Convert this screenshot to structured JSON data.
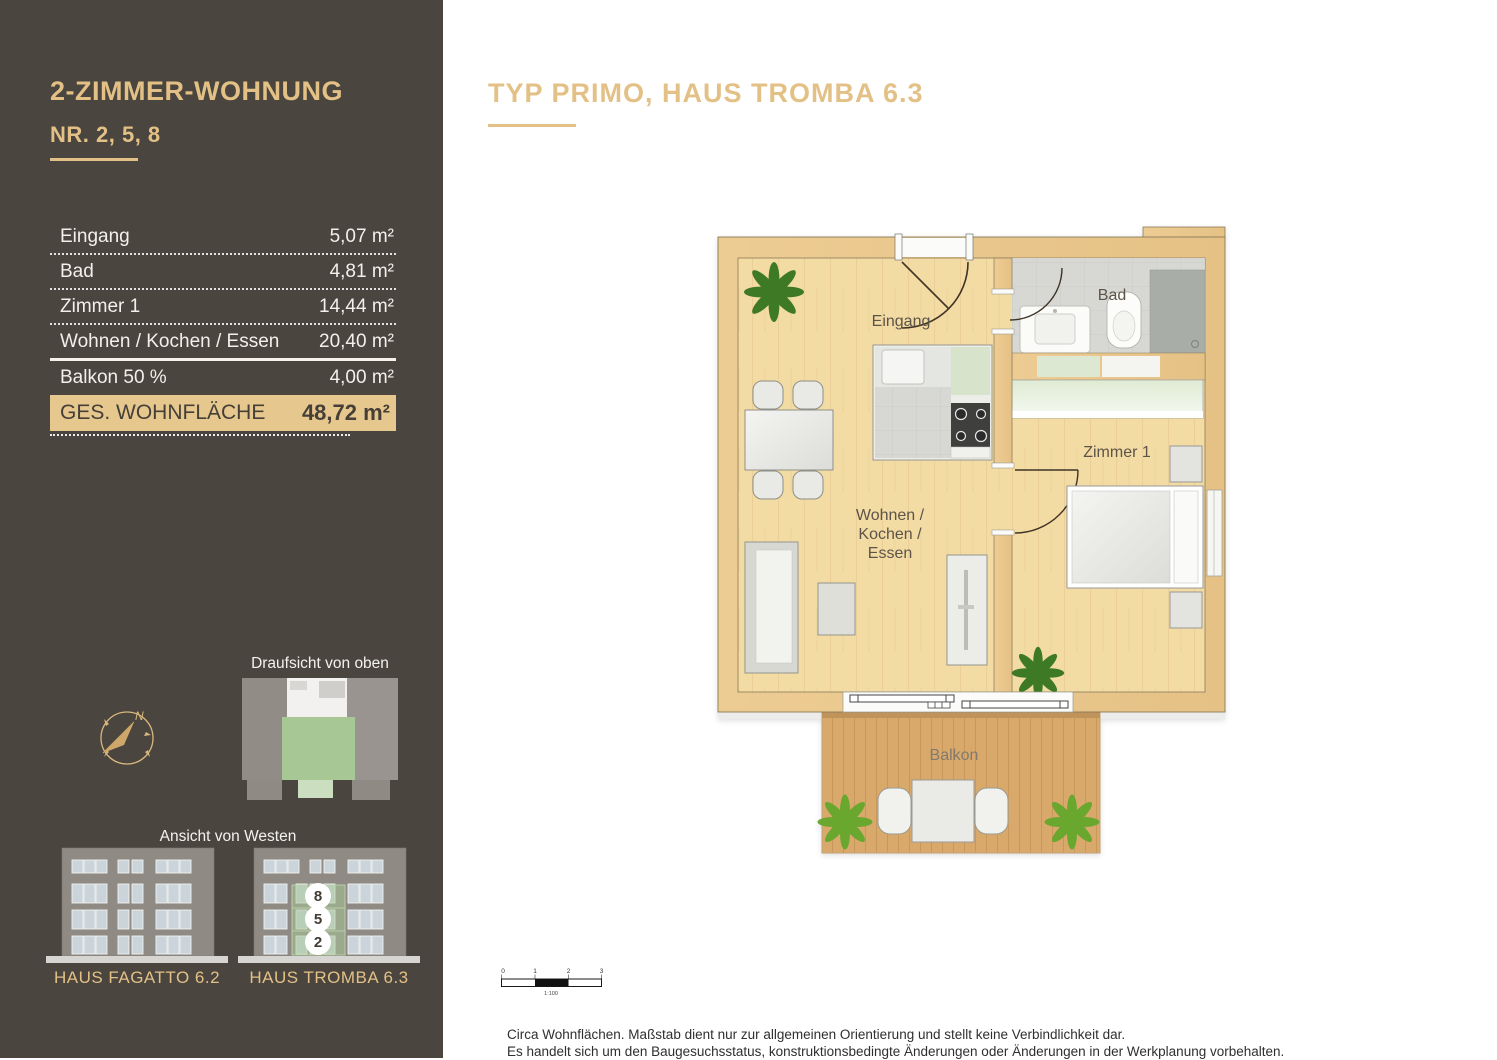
{
  "sidebar": {
    "title": "2-ZIMMER-WOHNUNG",
    "subtitle": "NR. 2, 5, 8",
    "area_table": {
      "rows": [
        {
          "label": "Eingang",
          "value": "5,07 m²"
        },
        {
          "label": "Bad",
          "value": "4,81 m²"
        },
        {
          "label": "Zimmer 1",
          "value": "14,44 m²"
        },
        {
          "label": "Wohnen / Kochen / Essen",
          "value": "20,40 m²"
        },
        {
          "label": "Balkon 50 %",
          "value": "4,00 m²"
        }
      ],
      "total": {
        "label": "GES. WOHNFLÄCHE",
        "value": "48,72 m²"
      }
    },
    "compass": {
      "north_label": "N"
    },
    "top_view": {
      "caption": "Draufsicht von oben"
    },
    "elevation": {
      "caption": "Ansicht von Westen",
      "buildings": [
        {
          "name": "HAUS FAGATTO 6.2",
          "highlighted": false
        },
        {
          "name": "HAUS TROMBA 6.3",
          "highlighted": true,
          "unit_numbers": [
            "8",
            "5",
            "2"
          ]
        }
      ]
    }
  },
  "main": {
    "title": "TYP PRIMO, HAUS TROMBA 6.3",
    "floor_plan": {
      "room_labels": {
        "eingang": "Eingang",
        "bad": "Bad",
        "zimmer1": "Zimmer 1",
        "wohnen": "Wohnen /",
        "kochen": "Kochen /",
        "essen": "Essen",
        "balkon": "Balkon"
      }
    },
    "scale_bar": {
      "ticks": [
        "0",
        "1",
        "2",
        "3"
      ],
      "ratio": "1:100"
    },
    "disclaimer": {
      "line1": "Circa Wohnflächen. Maßstab dient nur zur allgemeinen Orientierung und stellt keine Verbindlichkeit dar.",
      "line2": "Es handelt sich um den Baugesuchsstatus, konstruktionsbedingte Änderungen oder Änderungen in der Werkplanung vorbehalten."
    }
  },
  "colors": {
    "accent_gold": "#e3c186",
    "sidebar_bg": "#4a453e",
    "highlight_row_bg": "#e6c78e",
    "unit_green": "#a8c795",
    "floor_wood": "#f3dba4",
    "wall_wood": "#eac88e",
    "balcony_deck": "#d9a96b"
  }
}
